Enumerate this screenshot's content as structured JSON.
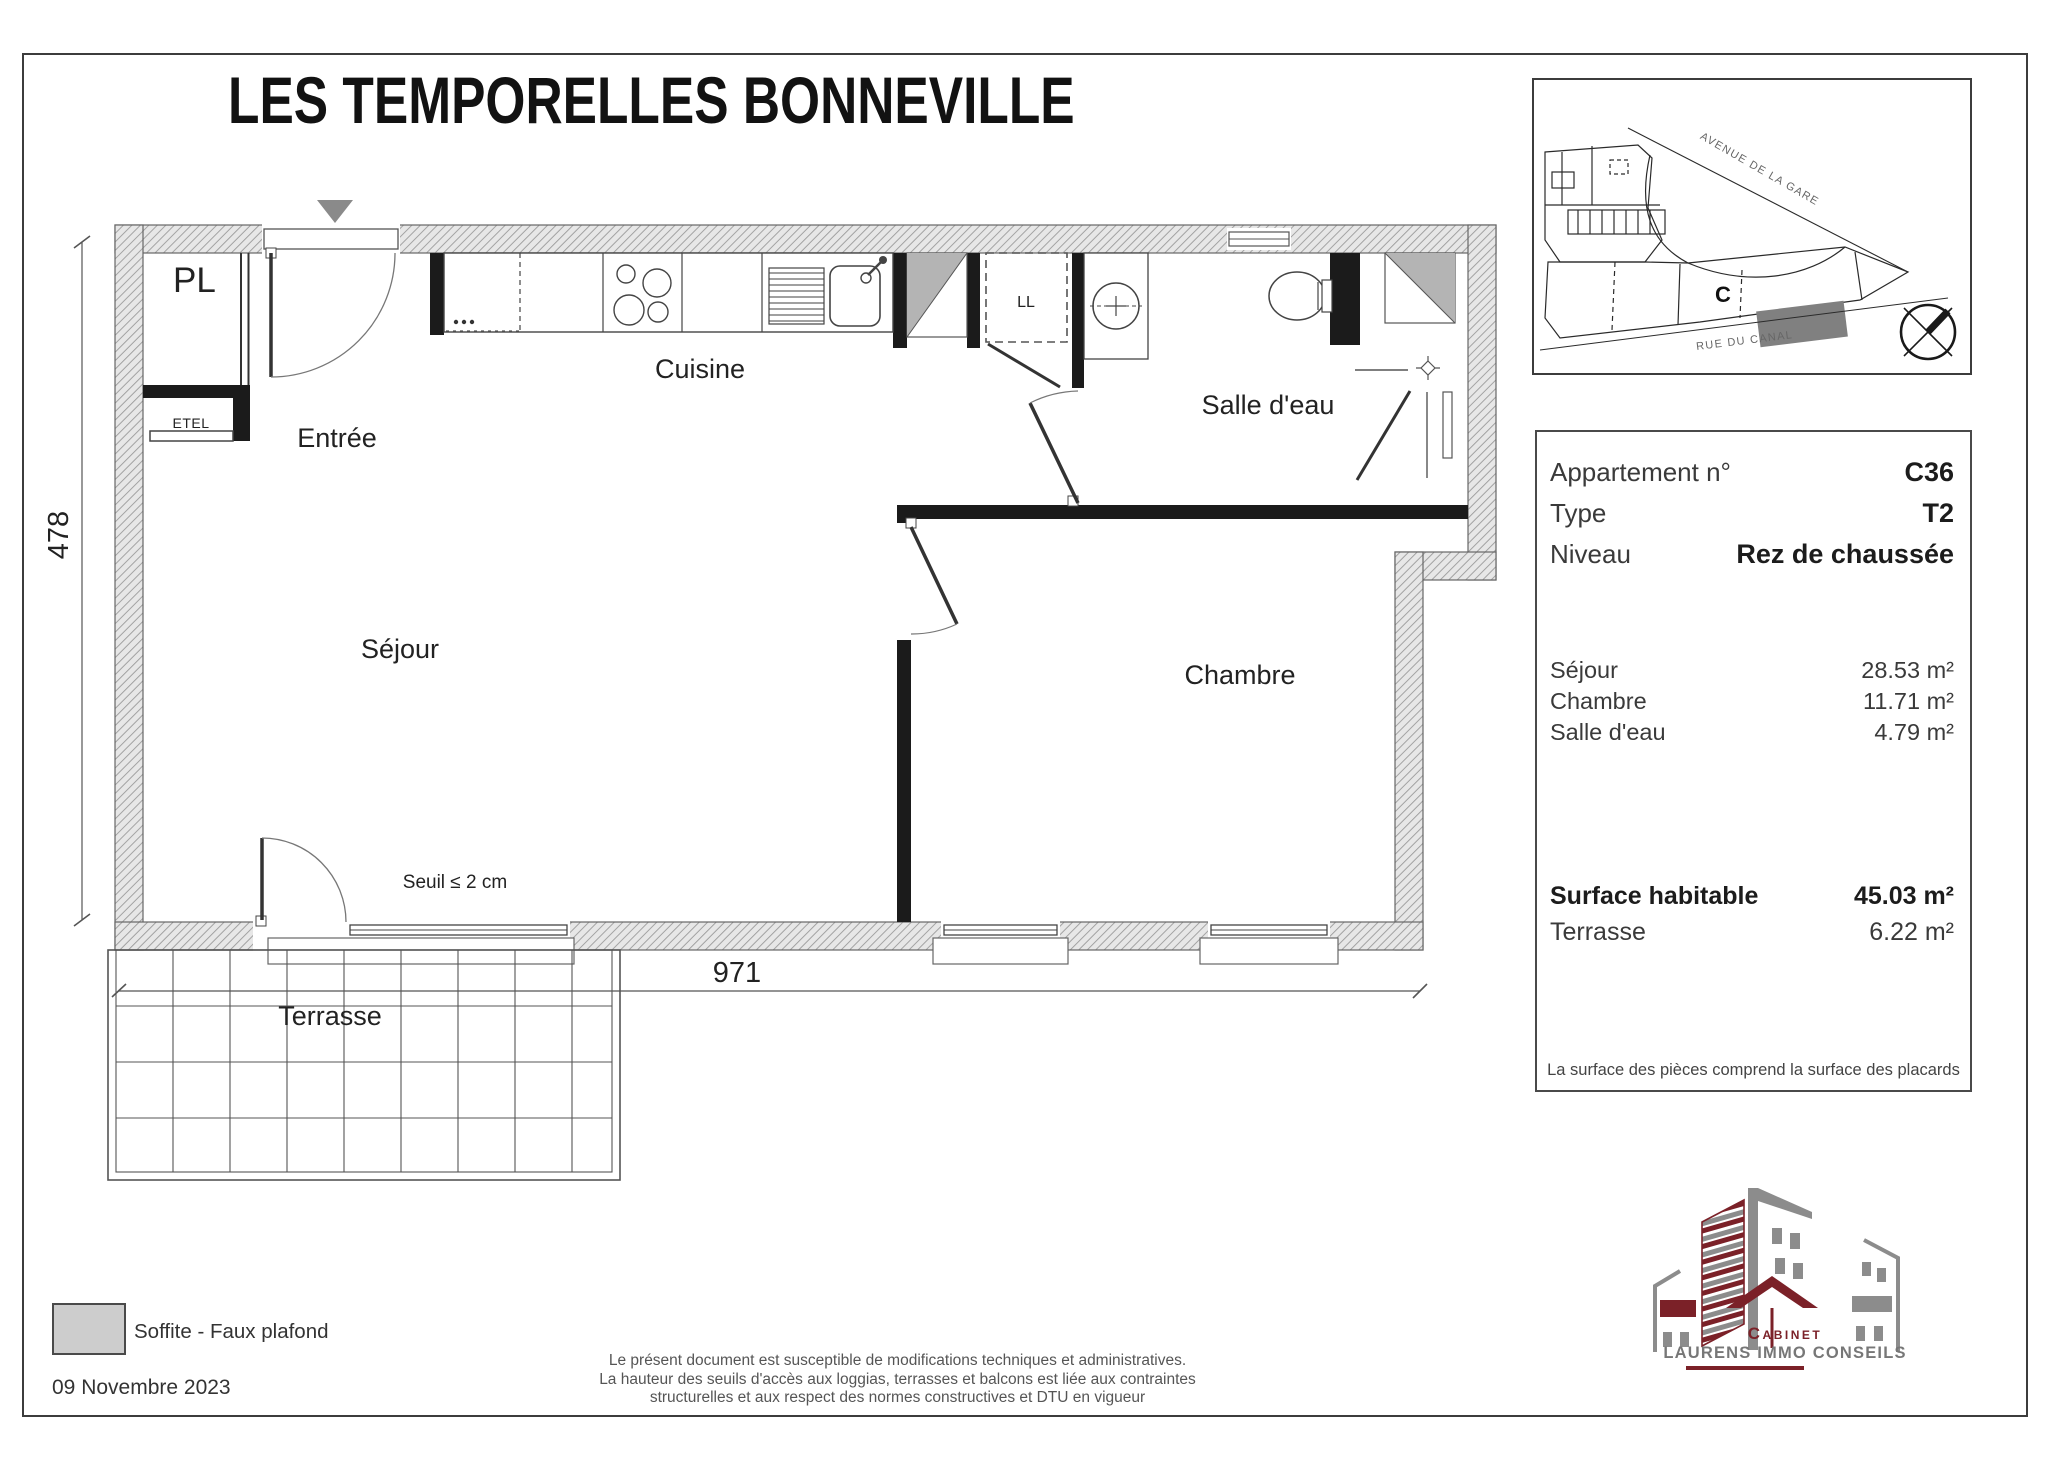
{
  "title": "LES TEMPORELLES BONNEVILLE",
  "site_map": {
    "street_top": "AVENUE DE LA GARE",
    "street_bottom": "RUE DU CANAL",
    "building_label": "C"
  },
  "info_panel": {
    "rows_top": [
      {
        "label": "Appartement n°",
        "value": "C36"
      },
      {
        "label": "Type",
        "value": "T2"
      },
      {
        "label": "Niveau",
        "value": "Rez de chaussée"
      }
    ],
    "rooms": [
      {
        "label": "Séjour",
        "value": "28.53 m²"
      },
      {
        "label": "Chambre",
        "value": "11.71 m²"
      },
      {
        "label": "Salle d'eau",
        "value": "4.79 m²"
      }
    ],
    "totals": [
      {
        "label": "Surface habitable",
        "value": "45.03 m²"
      },
      {
        "label": "Terrasse",
        "value": "6.22 m²"
      }
    ],
    "note": "La surface des pièces comprend la surface des placards"
  },
  "plan": {
    "labels": {
      "pl": "PL",
      "etel": "ETEL",
      "entree": "Entrée",
      "cuisine": "Cuisine",
      "ll": "LL",
      "salle_deau": "Salle d'eau",
      "sejour": "Séjour",
      "chambre": "Chambre",
      "terrasse": "Terrasse"
    },
    "annotations": {
      "seuil": "Seuil ≤ 2 cm"
    },
    "dimensions": {
      "width_cm": "971",
      "height_cm": "478"
    }
  },
  "legend": {
    "soffite": "Soffite - Faux plafond"
  },
  "footer": {
    "date": "09 Novembre 2023",
    "disclaimer": [
      "Le présent document est susceptible de modifications techniques et administratives.",
      "La hauteur des seuils d'accès aux loggias, terrasses et balcons est liée aux contraintes",
      "structurelles et aux respect des normes constructives et DTU en vigueur"
    ]
  },
  "logo": {
    "line1": "Cabinet",
    "line2": "LAURENS IMMO CONSEILS"
  },
  "colors": {
    "logo_maroon": "#7b2128",
    "logo_gray": "#8c8c8c",
    "soffite_gray": "#b4b4b4",
    "wall_black": "#1b1b1b",
    "hatch_gray": "#9b9b9b"
  }
}
